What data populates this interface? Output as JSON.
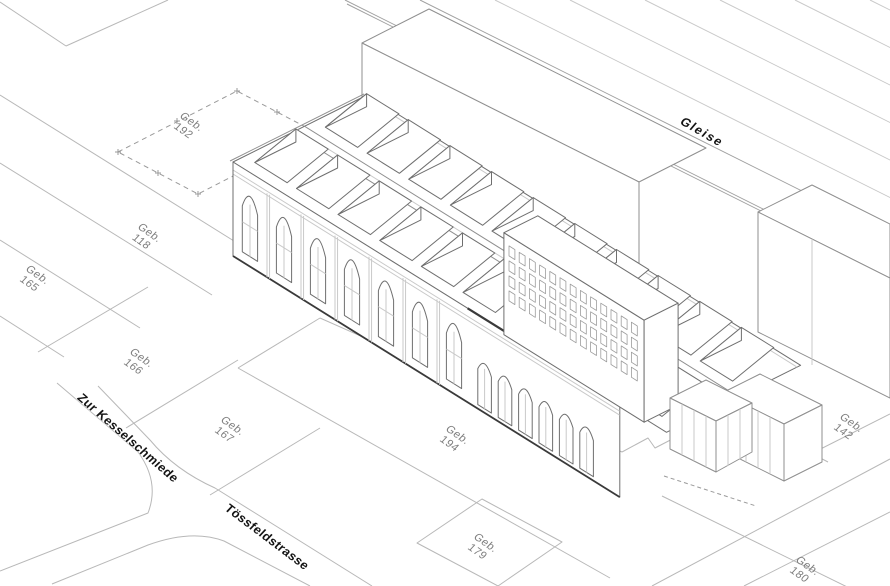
{
  "parcels": [
    {
      "prefix": "Geb.",
      "number": "192"
    },
    {
      "prefix": "Geb.",
      "number": "118"
    },
    {
      "prefix": "Geb.",
      "number": "165"
    },
    {
      "prefix": "Geb.",
      "number": "166"
    },
    {
      "prefix": "Geb.",
      "number": "167"
    },
    {
      "prefix": "Geb.",
      "number": "194"
    },
    {
      "prefix": "Geb.",
      "number": "179"
    },
    {
      "prefix": "Geb.",
      "number": "142"
    },
    {
      "prefix": "Geb.",
      "number": "180"
    }
  ],
  "streets": {
    "kesselschmiede": "Zur Kesselschmiede",
    "toessfeldstrasse": "Tössfeldstrasse"
  },
  "railway": {
    "label": "Gleise"
  },
  "palette": {
    "background": "#ffffff",
    "line": "#8f8f8f",
    "medium_line": "#6f6f6f",
    "light_line": "#c9c9c9",
    "track_dark": "#a0a0a0",
    "ground_line": "#b8b8b8",
    "dark_line": "#3a3a3a",
    "dash_line": "#9a9a9a",
    "window_line": "#9d9d9d",
    "label_gray": "#7d7d7d",
    "label_black": "#141414"
  }
}
